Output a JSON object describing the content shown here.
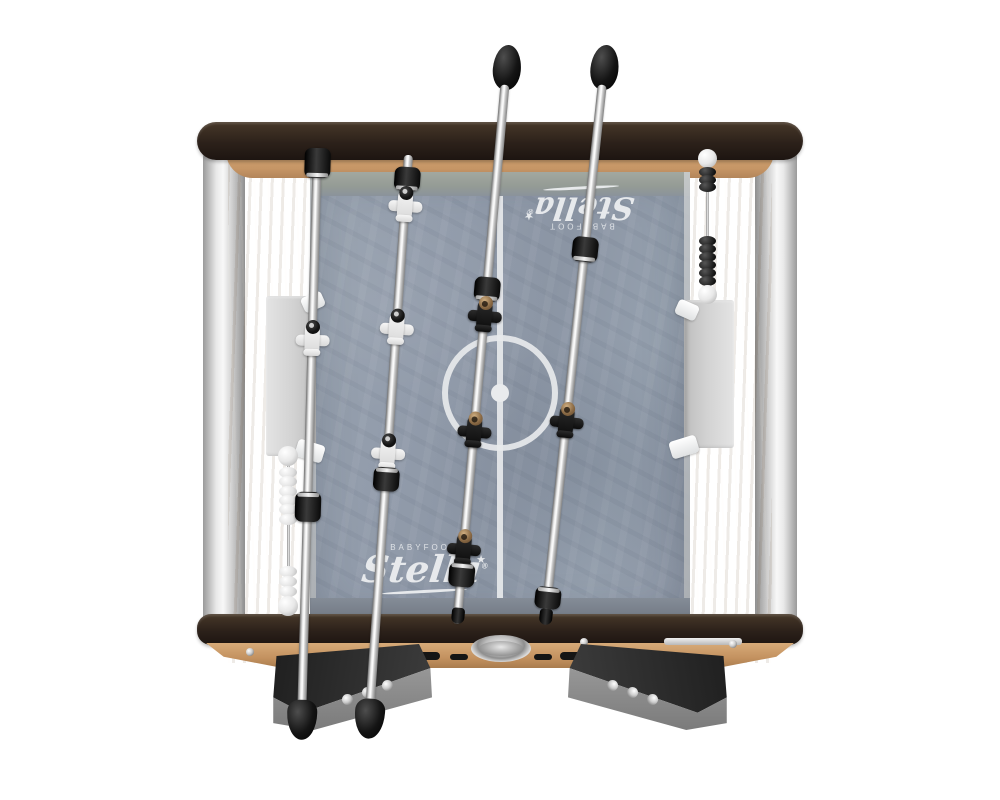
{
  "product": {
    "name": "Stella foosball table",
    "view": "top view product photo"
  },
  "branding": {
    "maker_label": "BABYFOOT",
    "brand_script": "Stella",
    "registered_mark": "®",
    "star_glyph": "★"
  },
  "teams": {
    "white": {
      "color": "#ededed",
      "players_visible": 4,
      "rods": 2
    },
    "black": {
      "color": "#1a1a1a",
      "players_visible": 4,
      "rods": 2
    }
  },
  "score_counters": {
    "left": {
      "cap_style": "white",
      "bead_style": "white",
      "groups": [
        6,
        3
      ]
    },
    "right": {
      "cap_style": "white",
      "bead_style": "black",
      "groups": [
        3,
        6
      ]
    }
  },
  "field": {
    "surface_color": "#929cab",
    "line_color": "#e7e9eb",
    "markings": [
      "center line",
      "center circle",
      "center spot"
    ]
  },
  "frame": {
    "rail_color": "#2c211a",
    "wood_color": "#c89a6a",
    "corner_trim_color": "#d9d9d9",
    "handle_color": "#111111"
  }
}
